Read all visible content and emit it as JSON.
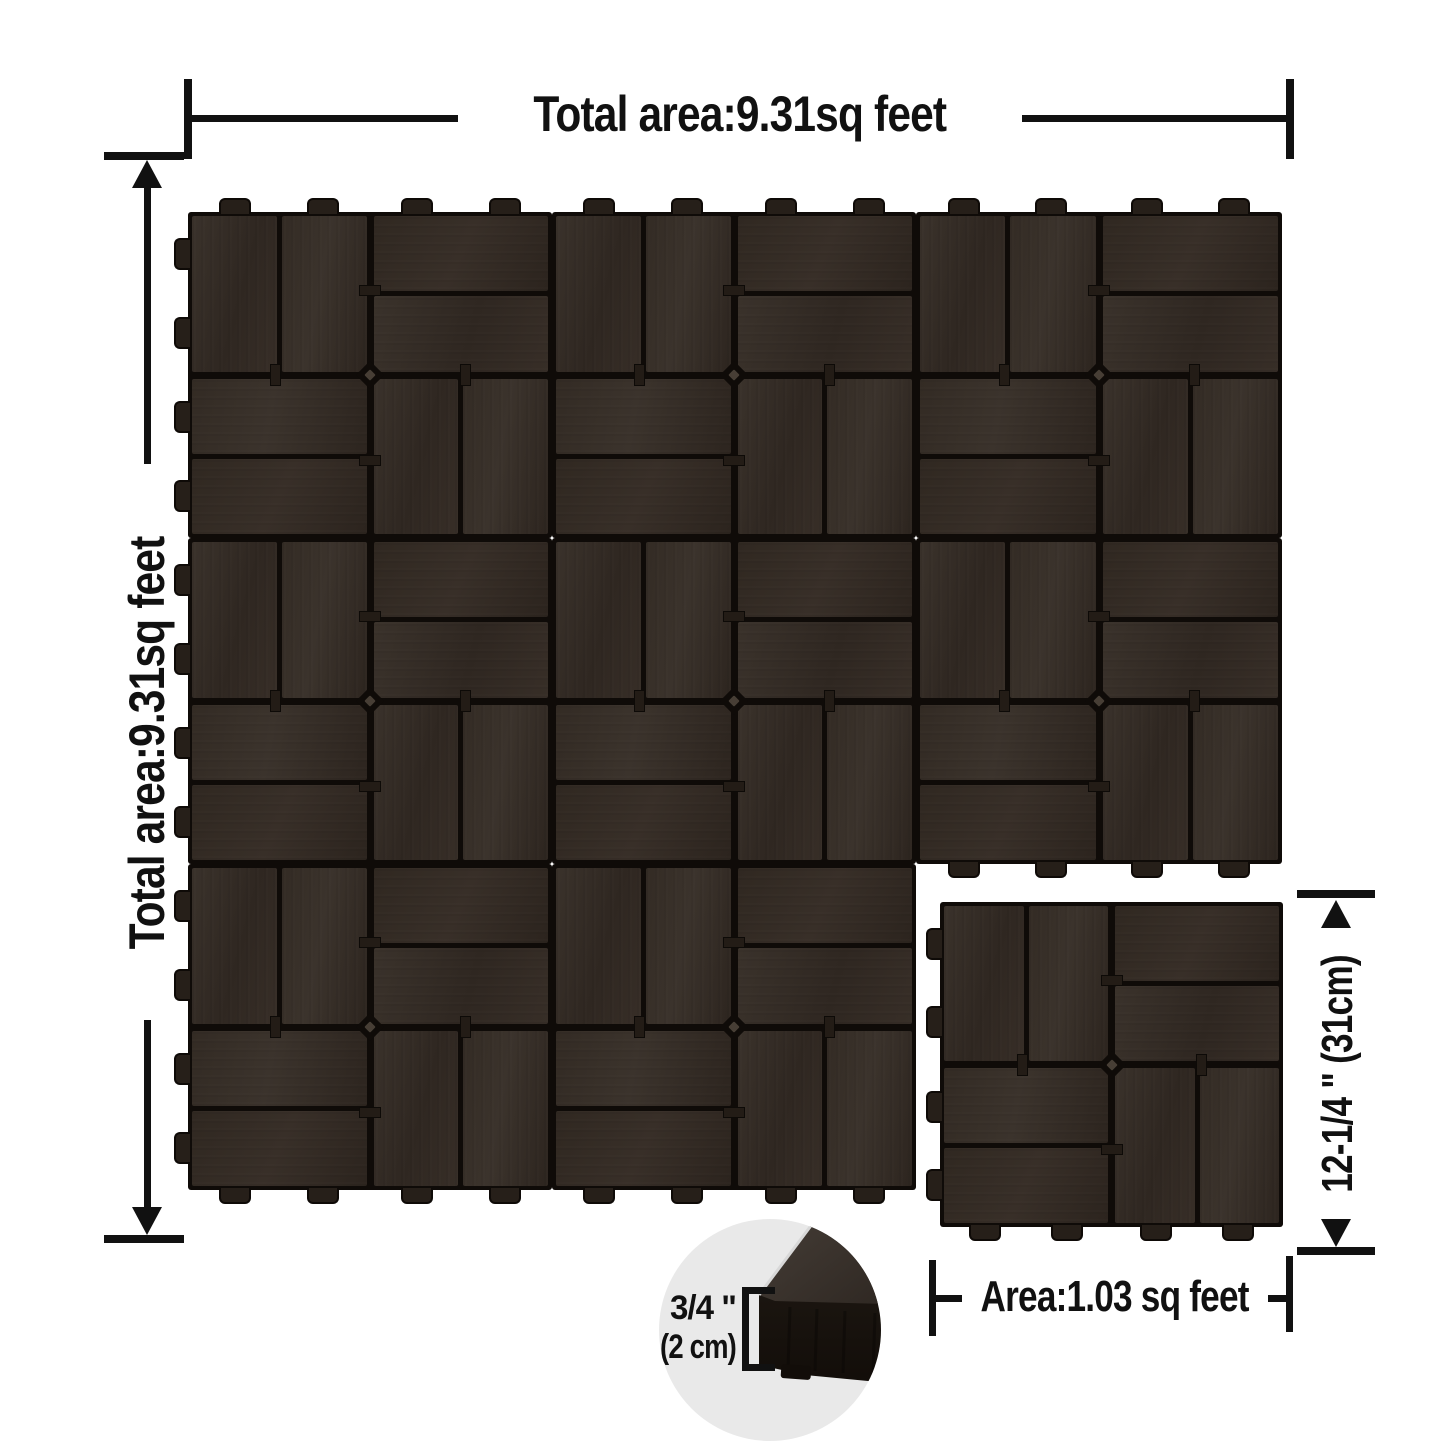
{
  "canvas": {
    "width": 1445,
    "height": 1445,
    "background": "#ffffff"
  },
  "colors": {
    "ink": "#111111",
    "tile_face": "#352c25",
    "tile_gap": "#0f0b08",
    "tab": "#261f19",
    "inset_bg": "#e9e9e9"
  },
  "annotations": {
    "top_dim": {
      "label": "Total area:9.31sq feet"
    },
    "left_dim": {
      "label": "Total area:9.31sq feet"
    },
    "right_dim": {
      "label": "12-1/4 \"  (31cm)"
    },
    "bottom_dim": {
      "label": "Area:1.03 sq feet"
    },
    "inset": {
      "thickness_inches": "3/4 \"",
      "thickness_cm": "(2 cm)"
    }
  },
  "tiles": [
    {
      "x": 188,
      "y": 212,
      "w": 364,
      "h": 326,
      "tabs": [
        "top",
        "left"
      ]
    },
    {
      "x": 552,
      "y": 212,
      "w": 364,
      "h": 326,
      "tabs": [
        "top"
      ]
    },
    {
      "x": 916,
      "y": 212,
      "w": 366,
      "h": 326,
      "tabs": [
        "top"
      ]
    },
    {
      "x": 188,
      "y": 538,
      "w": 364,
      "h": 326,
      "tabs": [
        "left"
      ]
    },
    {
      "x": 552,
      "y": 538,
      "w": 364,
      "h": 326,
      "tabs": []
    },
    {
      "x": 916,
      "y": 538,
      "w": 366,
      "h": 326,
      "tabs": [
        "bottom"
      ]
    },
    {
      "x": 188,
      "y": 864,
      "w": 364,
      "h": 326,
      "tabs": [
        "left",
        "bottom"
      ]
    },
    {
      "x": 552,
      "y": 864,
      "w": 364,
      "h": 326,
      "tabs": [
        "bottom"
      ]
    },
    {
      "x": 940,
      "y": 902,
      "w": 343,
      "h": 325,
      "tabs": [
        "left",
        "bottom"
      ]
    }
  ]
}
